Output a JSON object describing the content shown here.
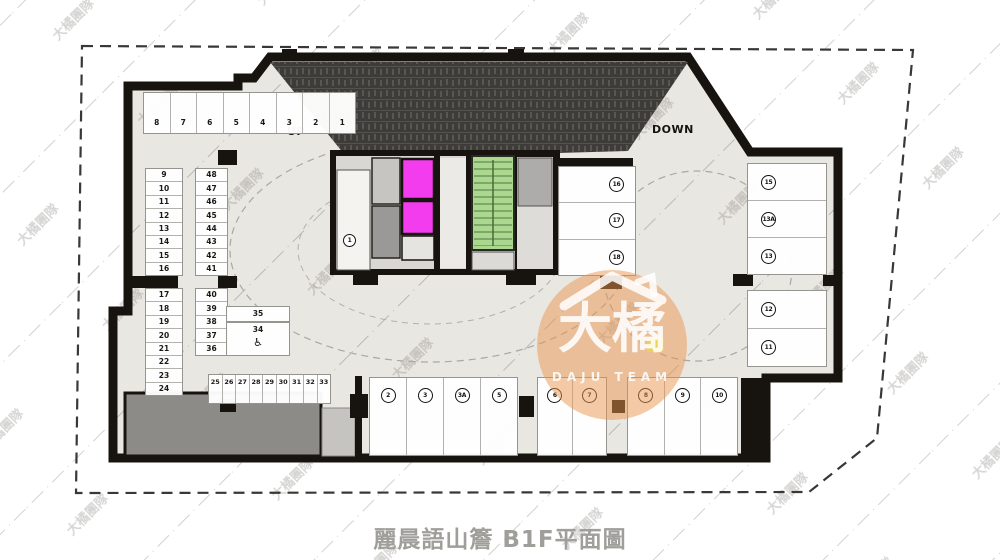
{
  "title": "麗晨語山簷 B1F平面圖",
  "labels": {
    "up": "UP",
    "down": "DOWN"
  },
  "watermark": {
    "tile": "大橘團隊",
    "logo_main": "大橘",
    "logo_sub": "DAJU TEAM"
  },
  "colors": {
    "wall": "#17140f",
    "floor": "#e9e7e2",
    "ramp": "#3e3c39",
    "elevator": "#f23ced",
    "stair": "#aad88e",
    "service": "#8d8b88",
    "logo": "#e9964e"
  },
  "icons": {
    "wheelchair": "♿"
  },
  "parking": {
    "top_row": [
      "8",
      "7",
      "6",
      "5",
      "4",
      "3",
      "2",
      "1"
    ],
    "col_9_16": [
      "9",
      "10",
      "11",
      "12",
      "13",
      "14",
      "15",
      "16"
    ],
    "col_48_41": [
      "48",
      "47",
      "46",
      "45",
      "44",
      "43",
      "42",
      "41"
    ],
    "col_17_24": [
      "17",
      "18",
      "19",
      "20",
      "21",
      "22",
      "23",
      "24"
    ],
    "col_40_36": [
      "40",
      "39",
      "38",
      "37",
      "36"
    ],
    "stall_35": "35",
    "stall_34": "34",
    "row_25_33": [
      "25",
      "26",
      "27",
      "28",
      "29",
      "30",
      "31",
      "32",
      "33"
    ],
    "unit_1": "1",
    "units_2_5": [
      "2",
      "3",
      "3A",
      "5"
    ],
    "units_6_7": [
      "6",
      "7"
    ],
    "units_8_10": [
      "8",
      "9",
      "10"
    ],
    "units_16_18": [
      "16",
      "17",
      "18"
    ],
    "units_15_13": [
      "15",
      "13A",
      "13"
    ],
    "units_12_11": [
      "12",
      "11"
    ]
  }
}
